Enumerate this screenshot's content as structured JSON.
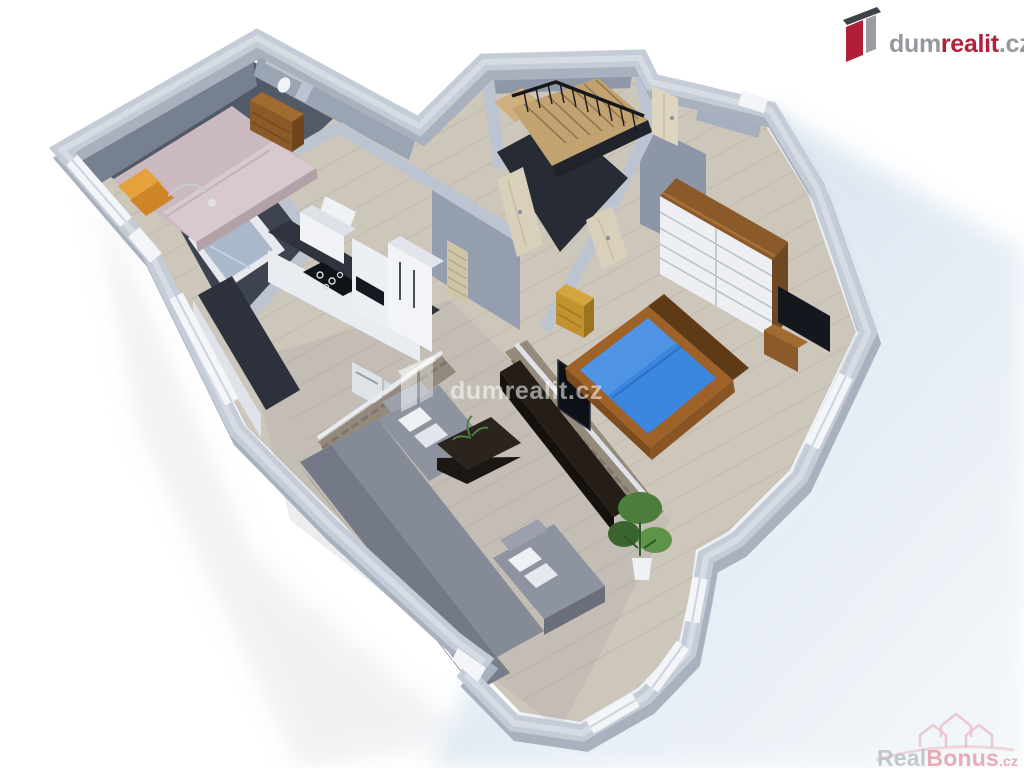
{
  "page": {
    "type": "real-estate-3d-floor-plan-render",
    "background": "#ffffff"
  },
  "branding_logo": {
    "prefix": "dum",
    "accent": "realit",
    "suffix": ".cz",
    "colors": {
      "prefix": "#97989d",
      "accent": "#b2203a",
      "suffix": "#97989d",
      "icon_dark": "#3f414b",
      "icon_red": "#b01f36",
      "icon_gray": "#9b9ca2"
    }
  },
  "watermark_center": {
    "text": "dumrealit.cz",
    "color": "#ffffff",
    "opacity": 0.55
  },
  "watermark_corner": {
    "prefix": "Real",
    "accent": "Bonus",
    "suffix": ".cz",
    "colors": {
      "prefix": "#b9bdc3",
      "accent": "#e59aa6"
    }
  },
  "scene": {
    "kind": "isometric 3D floor plan of an apartment, cast shadow to lower right",
    "shadow_color": "#cdd9e7",
    "wall_color": "#c4ccd8",
    "floor_wood_color": "#cdc6bb",
    "rooms": [
      "bedroom",
      "hallway",
      "bathroom",
      "wc",
      "kitchen",
      "living-room",
      "dining-bay",
      "second-bedroom",
      "staircase",
      "entry-corridor"
    ],
    "objects": [
      "pink-double-bed-with-orange-pillows",
      "brown-wardrobe",
      "bathtub",
      "washbasin",
      "toilet",
      "kitchen-counter-black-cooktop",
      "fridge",
      "oven-column",
      "cooker-hood",
      "washing-machines",
      "stone-accent-half-walls",
      "gray-corner-sofa-white-pillows",
      "dark-coffee-table-with-plant",
      "dark-tv-lowboard",
      "flat-tv",
      "potted-plant",
      "blue-double-bed-wood-frame",
      "white-sliding-wardrobe-wood-trim",
      "ochre-dresser",
      "wooden-staircase-black-railing",
      "light-wood-interior-doors",
      "white-framed-windows"
    ],
    "accents": {
      "bed_blue": "#3b86de",
      "bed_pink": "#cbb9c0",
      "sofa_gray": "#7e8390",
      "wood_furniture": "#8b5a2a",
      "ochre": "#c2922e"
    }
  }
}
